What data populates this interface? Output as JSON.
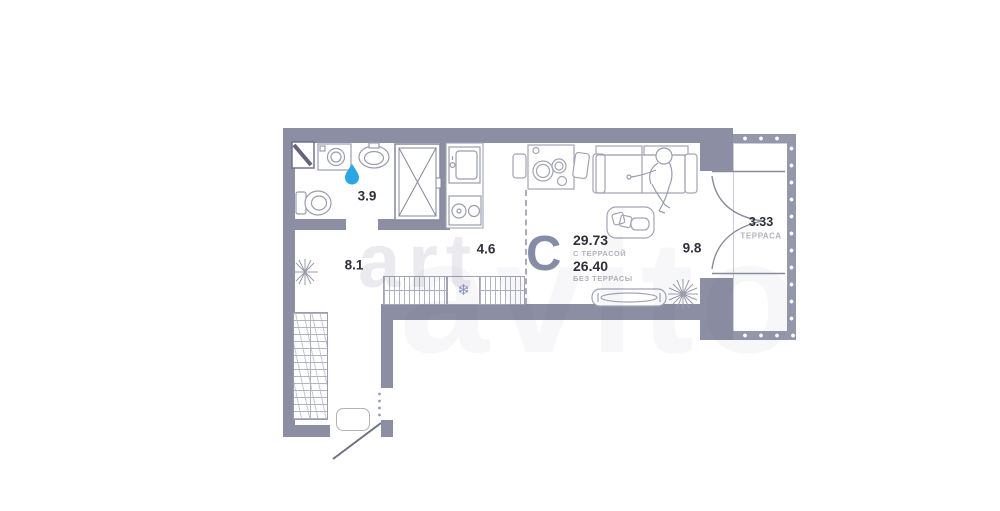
{
  "plan": {
    "type_letter": "С",
    "area_with_terrace": {
      "value": "29.73",
      "label": "С ТЕРРАСОЙ"
    },
    "area_without_terrace": {
      "value": "26.40",
      "label": "БЕЗ ТЕРРАСЫ"
    },
    "rooms": [
      {
        "id": "bathroom",
        "area": "3.9"
      },
      {
        "id": "hallway",
        "area": "8.1"
      },
      {
        "id": "kitchen",
        "area": "4.6"
      },
      {
        "id": "living-room",
        "area": "9.8"
      },
      {
        "id": "terrace",
        "area": "3.33",
        "label": "ТЕРРАСА"
      }
    ],
    "icons": {
      "water_drop": "water-drop-icon",
      "snowflake": "❄"
    },
    "colors": {
      "wall": "#8c8ea3",
      "water_drop": "#2ba6e2",
      "type_letter": "#858da6",
      "area_text": "#2f3038",
      "muted_label": "#b2b2bf",
      "snowflake": "#8a93cf"
    }
  },
  "watermark": {
    "small": "art",
    "large": "avito"
  }
}
